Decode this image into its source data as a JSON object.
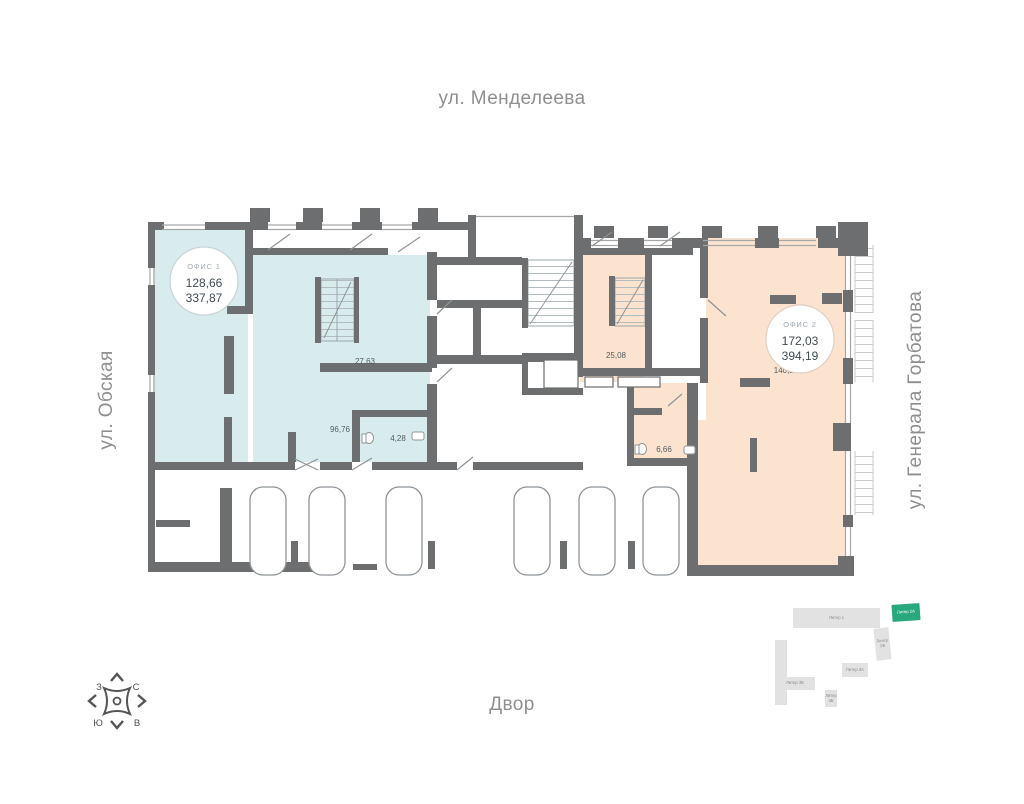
{
  "streets": {
    "top": "ул. Менделеева",
    "left": "ул. Обская",
    "right": "ул. Генерала Горбатова",
    "bottom": "Двор"
  },
  "compass": {
    "nw": "З",
    "ne": "С",
    "sw": "Ю",
    "se": "В"
  },
  "offices": {
    "office1": {
      "name": "ОФИС 1",
      "area": "128,66",
      "total_area": "337,87",
      "fill": "#d9eced",
      "rooms": {
        "hall": "27,63",
        "main": "96,76",
        "wc": "4,28"
      }
    },
    "office2": {
      "name": "ОФИС 2",
      "area": "172,03",
      "total_area": "394,19",
      "fill": "#fbe3cf",
      "rooms": {
        "hall": "25,08",
        "main": "140,29",
        "wc": "6,66"
      }
    }
  },
  "sitemap": {
    "active_color": "#2aa87d",
    "blocks": [
      {
        "label": "Литер 1",
        "active": false
      },
      {
        "label": "Литер 2А",
        "active": true
      },
      {
        "label": "Литер 2Б",
        "active": false
      },
      {
        "label": "Литер 3А",
        "active": false
      },
      {
        "label": "Литер 3Б",
        "active": false
      },
      {
        "label": "Литер 4Б",
        "active": false
      }
    ]
  },
  "colors": {
    "wall": "#6c6e6f",
    "office1_fill": "#d9eced",
    "office2_fill": "#fbe3cf"
  }
}
